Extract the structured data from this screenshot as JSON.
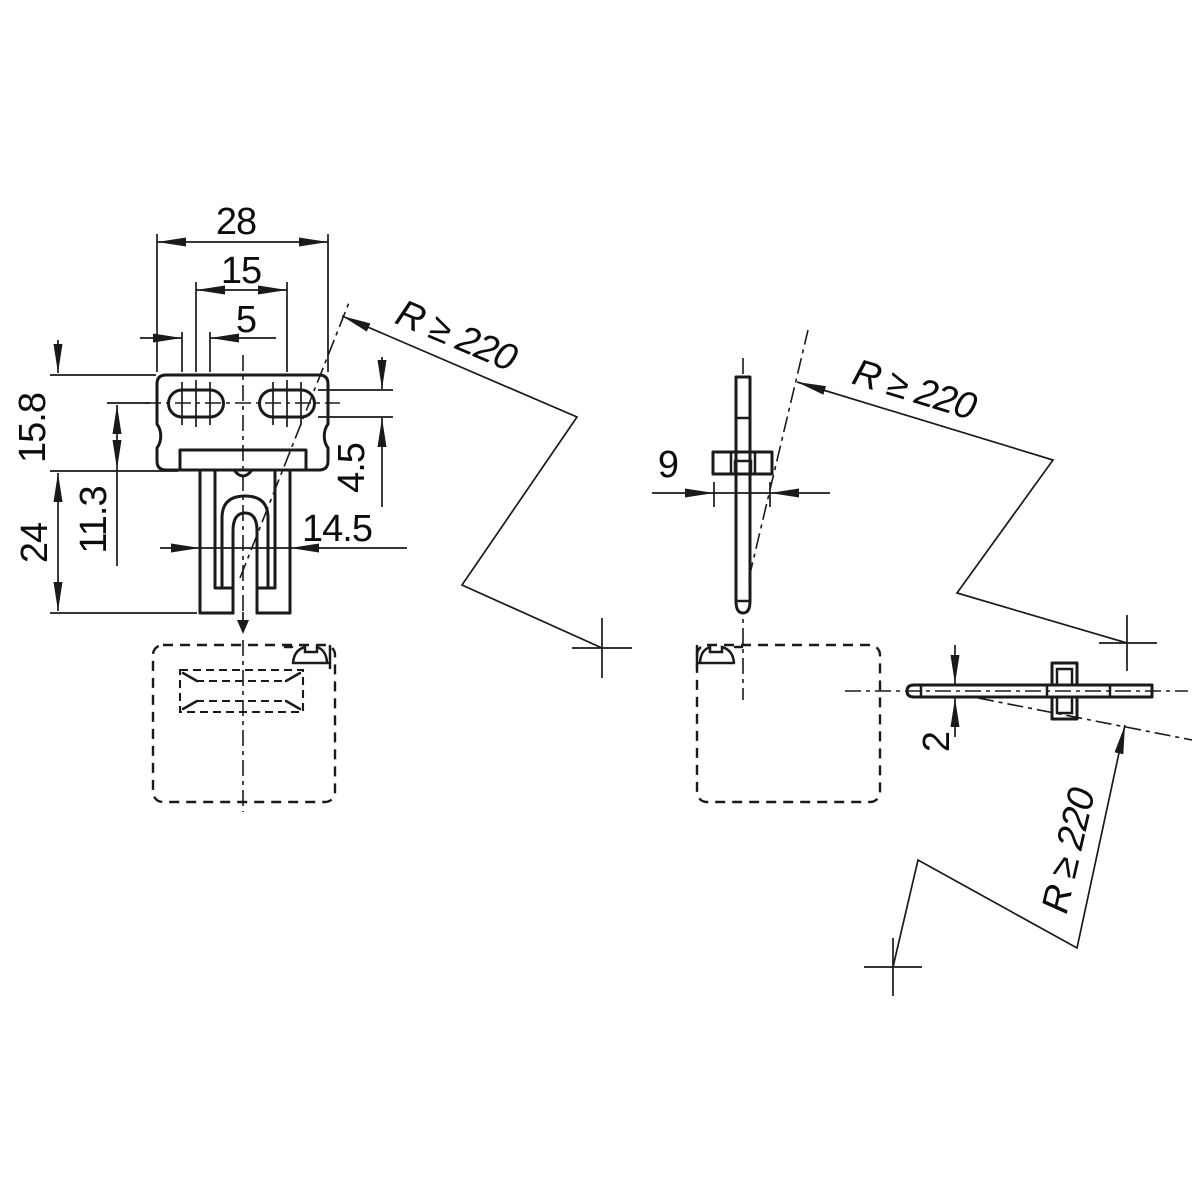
{
  "drawing": {
    "background": "#ffffff",
    "ink": "#1a1a1c",
    "views": {
      "front": {
        "dims": {
          "width": "28",
          "slot_spacing": "15",
          "slot_center_offset": "5",
          "head_height": "15.8",
          "slot_axis_to_shoulder": "11.3",
          "leg_length": "24",
          "slot_height": "4.5",
          "leg_span": "14.5"
        },
        "radius_note": "R ≥ 220"
      },
      "side": {
        "dims": {
          "flange_width": "9"
        },
        "radius_note": "R ≥ 220"
      },
      "top": {
        "dims": {
          "material_thickness": "2"
        },
        "radius_note": "R ≥ 220"
      }
    }
  }
}
